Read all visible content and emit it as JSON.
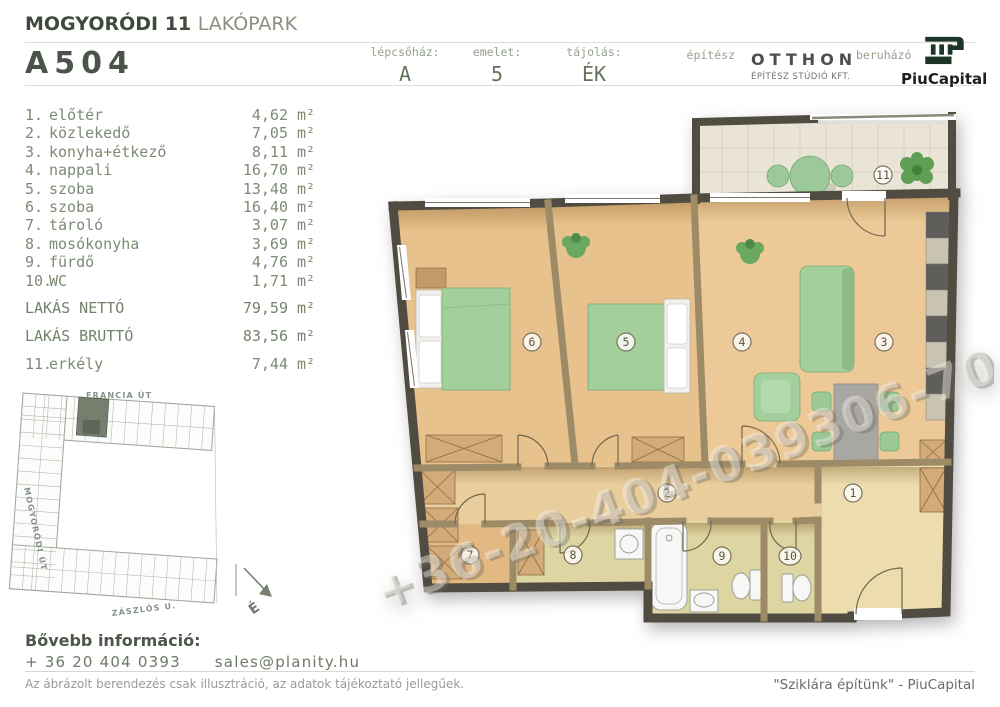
{
  "header": {
    "project_title_bold": "MOGYORÓDI 11",
    "project_title_light": "LAKÓPARK",
    "unit_code": "A504",
    "meta": [
      {
        "label": "lépcsőház:",
        "value": "A"
      },
      {
        "label": "emelet:",
        "value": "5"
      },
      {
        "label": "tájolás:",
        "value": "ÉK"
      }
    ],
    "architect_label": "építész",
    "architect_name": "OTTHON",
    "architect_subtitle": "ÉPÍTÉSZ STÚDIÓ KFT.",
    "developer_label": "beruházó",
    "developer_name": "PiuCapital"
  },
  "room_list": {
    "unit_suffix": "m²",
    "rooms": [
      {
        "num": "1.",
        "name": "előtér",
        "area": "4,62"
      },
      {
        "num": "2.",
        "name": "közlekedő",
        "area": "7,05"
      },
      {
        "num": "3.",
        "name": "konyha+étkező",
        "area": "8,11"
      },
      {
        "num": "4.",
        "name": "nappali",
        "area": "16,70"
      },
      {
        "num": "5.",
        "name": "szoba",
        "area": "13,48"
      },
      {
        "num": "6.",
        "name": "szoba",
        "area": "16,40"
      },
      {
        "num": "7.",
        "name": "tároló",
        "area": "3,07"
      },
      {
        "num": "8.",
        "name": "mosókonyha",
        "area": "3,69"
      },
      {
        "num": "9.",
        "name": "fürdő",
        "area": "4,76"
      },
      {
        "num": "10.",
        "name": "WC",
        "area": "1,71"
      }
    ],
    "totals": [
      {
        "label": "LAKÁS NETTÓ",
        "area": "79,59"
      },
      {
        "label": "LAKÁS BRUTTÓ",
        "area": "83,56"
      }
    ],
    "balcony_row": {
      "num": "11.",
      "name": "erkély",
      "area": "7,44"
    }
  },
  "site_plan": {
    "street_top": "FRANCIA ÚT",
    "street_left": "MOGYORÓDI ÚT",
    "street_bottom": "ZÁSZLÓS U.",
    "north_label": "É"
  },
  "floor_plan": {
    "watermark": "+36-20-404-039306-70-442-2",
    "room_labels": [
      "1",
      "2",
      "3",
      "4",
      "5",
      "6",
      "7",
      "8",
      "9",
      "10",
      "11"
    ]
  },
  "contact": {
    "heading": "Bővebb információ:",
    "phone": "+ 36 20 404 0393",
    "email": "sales@planity.hu"
  },
  "footer": {
    "disclaimer": "Az ábrázolt berendezés csak illusztráció, az adatok tájékoztató jellegűek.",
    "slogan": "\"Sziklára építünk\" - PiuCapital"
  },
  "colors": {
    "accent_dark_green": "#1c3527",
    "text_sage": "#7c8b74",
    "wall_exterior": "#514c41",
    "wall_interior": "#9d8b68",
    "floor_wood": "#e7c28c",
    "furniture_green": "#a3cf9c"
  }
}
